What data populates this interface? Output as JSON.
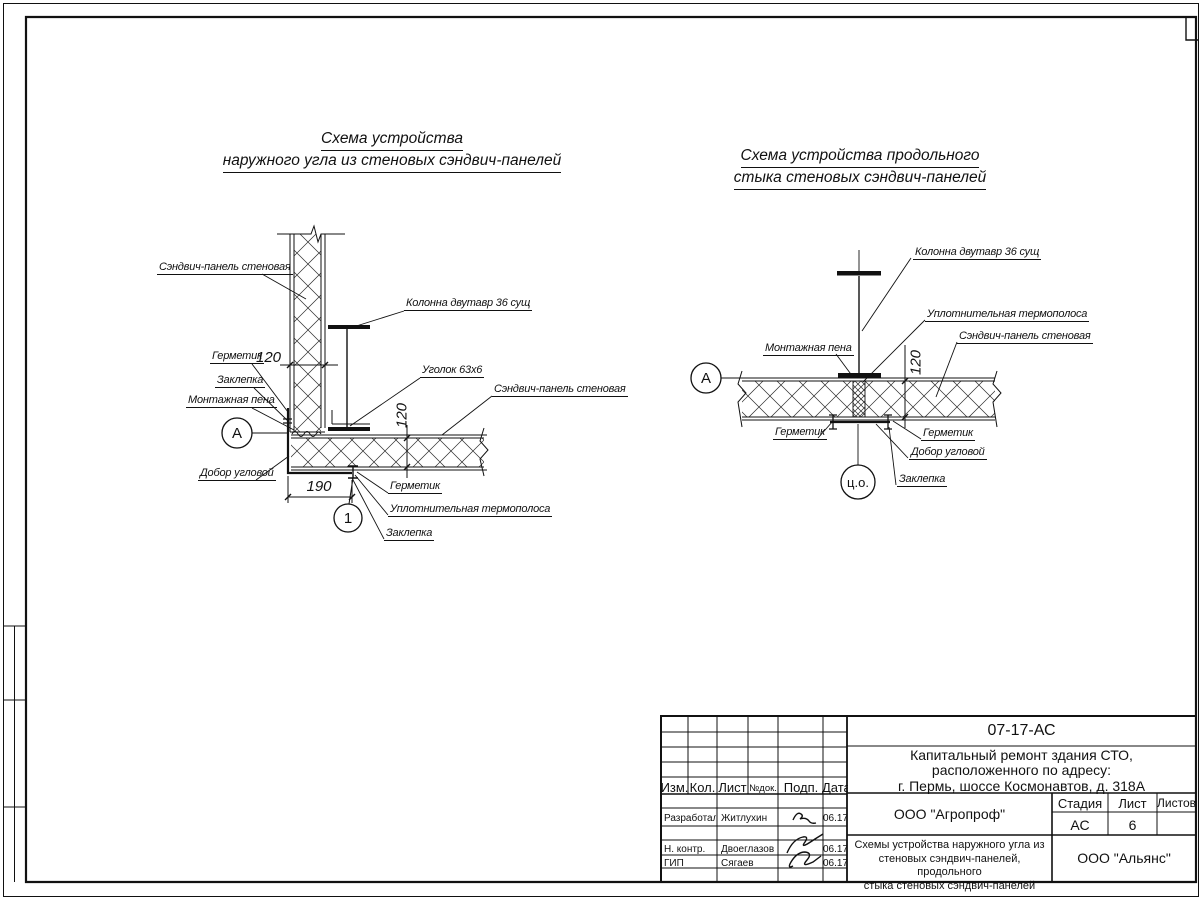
{
  "left_diagram": {
    "title_line1": "Схема устройства",
    "title_line2": "наружного угла из стеновых сэндвич-панелей",
    "labels": {
      "panel_top": "Сэндвич-панель стеновая",
      "column": "Колонна двутавр 36 сущ",
      "angle": "Уголок 63х6",
      "panel_right": "Сэндвич-панель стеновая",
      "sealant_top": "Герметик",
      "rivet_top": "Заклепка",
      "foam": "Монтажная пена",
      "corner_trim": "Добор угловой",
      "sealant_bottom": "Герметик",
      "thermal_strip": "Уплотнительная термополоса",
      "rivet_bottom": "Заклепка"
    },
    "dims": {
      "panel_thickness_top": "120",
      "panel_thickness_right": "120",
      "corner_width": "190"
    },
    "markers": {
      "axis": "А",
      "detail": "1"
    }
  },
  "right_diagram": {
    "title_line1": "Схема устройства продольного",
    "title_line2": "стыка стеновых сэндвич-панелей",
    "labels": {
      "column": "Колонна двутавр 36 сущ",
      "thermal_strip": "Уплотнительная термополоса",
      "panel": "Сэндвич-панель стеновая",
      "foam": "Монтажная пена",
      "sealant_left": "Герметик",
      "sealant_right": "Герметик",
      "corner_trim": "Добор угловой",
      "rivet": "Заклепка"
    },
    "dims": {
      "panel_thickness": "120"
    },
    "markers": {
      "axis": "А",
      "center_axis": "ц.о."
    }
  },
  "title_block": {
    "doc_code": "07-17-АС",
    "project_line1": "Капитальный ремонт здания СТО,",
    "project_line2": "расположенного по адресу:",
    "project_line3": "г. Пермь, шоссе Космонавтов, д. 318А",
    "columns": [
      "Изм.",
      "Кол.",
      "Лист",
      "№док.",
      "Подп.",
      "Дата"
    ],
    "rows": [
      {
        "role": "Разработал",
        "name": "Житлухин",
        "date": "06.17"
      },
      {
        "role": "Н. контр.",
        "name": "Двоеглазов",
        "date": "06.17"
      },
      {
        "role": "ГИП",
        "name": "Сягаев",
        "date": "06.17"
      }
    ],
    "org_designer": "ООО \"Агропроф\"",
    "org_customer": "ООО \"Альянс\"",
    "stage_label": "Стадия",
    "sheet_label": "Лист",
    "sheets_label": "Листов",
    "stage_value": "АС",
    "sheet_value": "6",
    "sheet_title_line1": "Схемы устройства наружного угла из",
    "sheet_title_line2": "стеновых сэндвич-панелей, продольного",
    "sheet_title_line3": "стыка стеновых сэндвич-панелей"
  }
}
